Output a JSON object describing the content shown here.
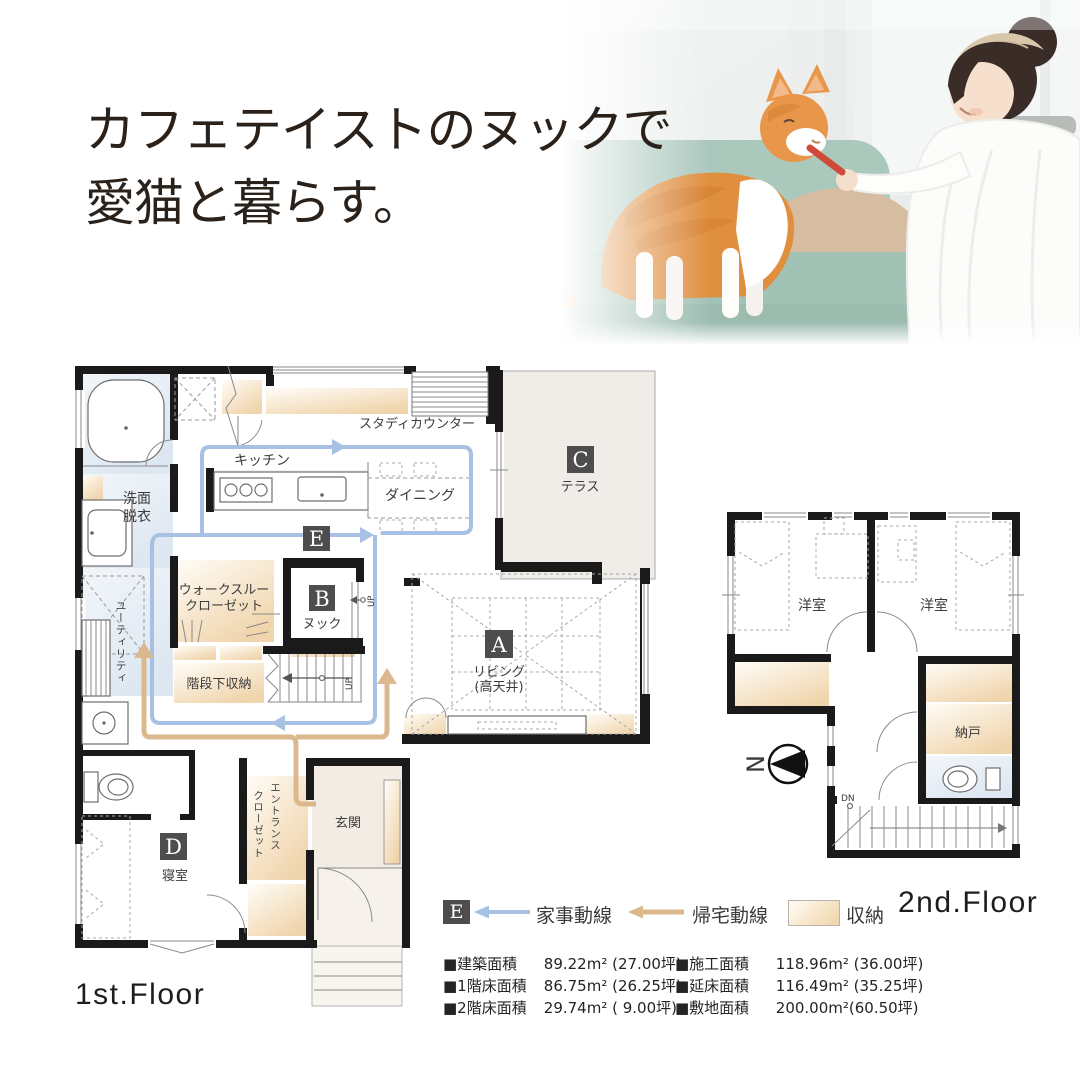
{
  "page": {
    "width": 1080,
    "height": 1080,
    "background": "#ffffff"
  },
  "colors": {
    "wall": "#1a1a1a",
    "flow_housework": "#a6c1e3",
    "flow_return": "#dcb88e",
    "storage_fill": "#f2d6ae",
    "tag_box": "#4d4d4d",
    "water_fill": "#e7eef6",
    "terrace_fill": "#f0ede8",
    "headline_text": "#2a211a",
    "sofa": "#a9c6bb",
    "cat": "#e8964a"
  },
  "header": {
    "headline_line1": "カフェテイストのヌックで",
    "headline_line2": "愛猫と暮らす。"
  },
  "floor1": {
    "label": "1st.Floor",
    "tags": {
      "living": "A",
      "nook": "B",
      "terrace": "C",
      "bedroom": "D",
      "flow": "E"
    },
    "rooms": {
      "washroom_line1": "洗面",
      "washroom_line2": "脱衣",
      "kitchen": "キッチン",
      "dining": "ダイニング",
      "study_counter": "スタディカウンター",
      "terrace": "テラス",
      "living": "リビング",
      "living_note": "(高天井)",
      "nook": "ヌック",
      "wtc_line1": "ウォークスルー",
      "wtc_line2": "クローゼット",
      "understairs": "階段下収納",
      "utility": "ユーティリティ",
      "entrance_closet_line1": "エントランス",
      "entrance_closet_line2": "クローゼット",
      "entrance": "玄関",
      "bedroom": "寝室"
    },
    "marks": {
      "up": "UP",
      "up_nook": "UP"
    }
  },
  "floor2": {
    "label": "2nd.Floor",
    "rooms": {
      "western_room_left": "洋室",
      "western_room_right": "洋室",
      "storeroom": "納戸"
    },
    "marks": {
      "down": "DN",
      "north": "N"
    }
  },
  "legend": {
    "flow_tag": "E",
    "housework_line": "家事動線",
    "return_line": "帰宅動線",
    "storage": "収納"
  },
  "areas": {
    "left": [
      {
        "name": "■建築面積",
        "value": "89.22m² (27.00坪)"
      },
      {
        "name": "■1階床面積",
        "value": "86.75m² (26.25坪)"
      },
      {
        "name": "■2階床面積",
        "value": "29.74m² ( 9.00坪)"
      }
    ],
    "right": [
      {
        "name": "■施工面積",
        "value": "118.96m² (36.00坪)"
      },
      {
        "name": "■延床面積",
        "value": "116.49m² (35.25坪)"
      },
      {
        "name": "■敷地面積",
        "value": "200.00m²(60.50坪)"
      }
    ]
  }
}
